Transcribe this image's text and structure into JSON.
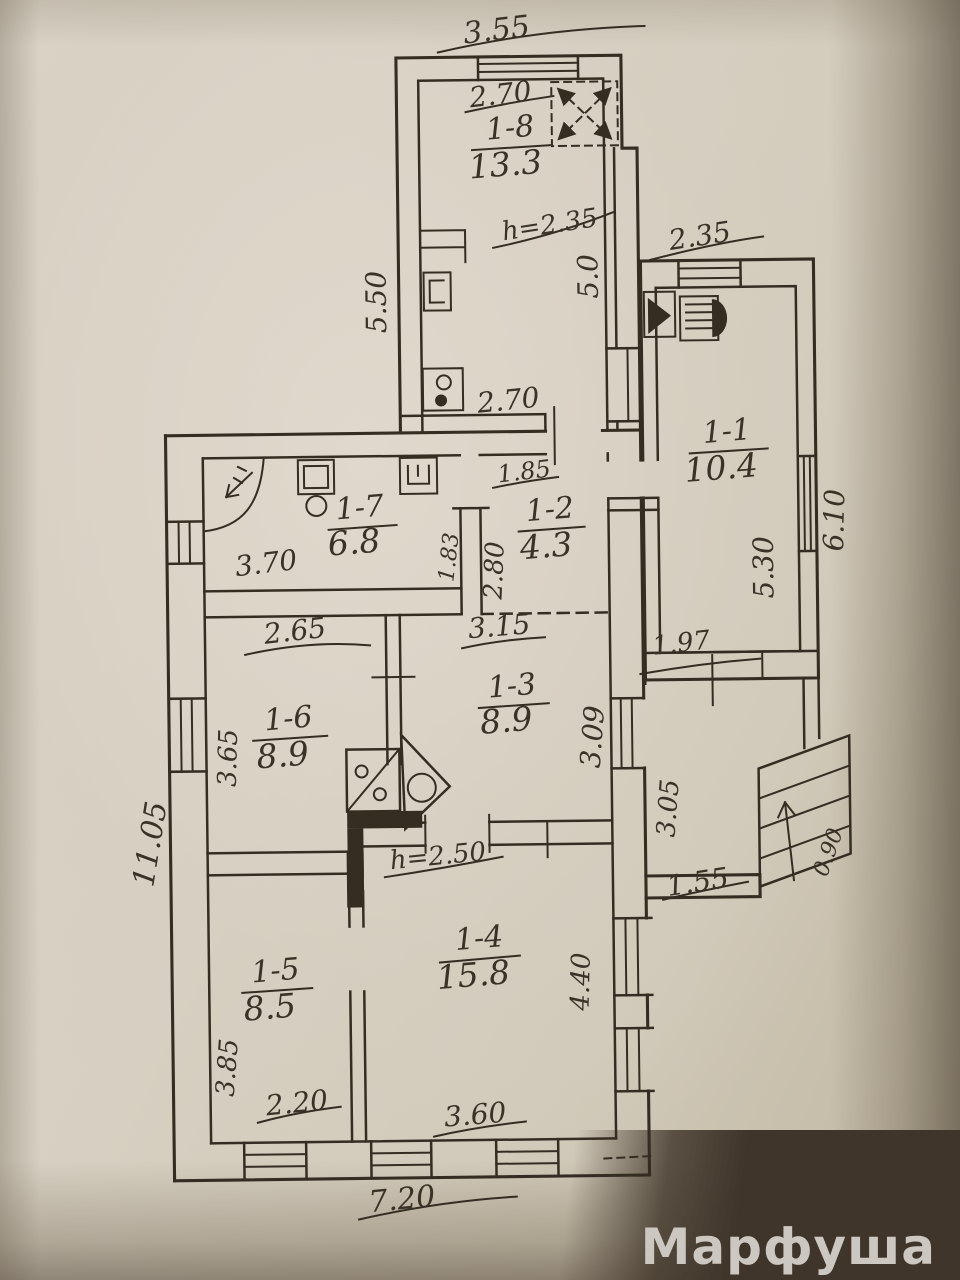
{
  "photo": {
    "watermark": "Марфуша"
  },
  "plan": {
    "rooms": {
      "r18": {
        "num": "1-8",
        "area": "13.3"
      },
      "r11": {
        "num": "1-1",
        "area": "10.4"
      },
      "r17": {
        "num": "1-7",
        "area": "6.8"
      },
      "r12": {
        "num": "1-2",
        "area": "4.3"
      },
      "r16": {
        "num": "1-6",
        "area": "8.9"
      },
      "r13": {
        "num": "1-3",
        "area": "8.9"
      },
      "r15": {
        "num": "1-5",
        "area": "8.5"
      },
      "r14": {
        "num": "1-4",
        "area": "15.8"
      }
    },
    "dims": {
      "top_width": "3.55",
      "r18_top": "2.70",
      "r18_height_note": "h=2.35",
      "r18_left": "5.50",
      "r18_right": "5.0",
      "r18_bottom": "2.70",
      "r11_top": "2.35",
      "r11_inner_right": "5.30",
      "r11_outer_right": "6.10",
      "r11_bottom": "1.97",
      "r17_bottom": "3.70",
      "r17_right": "1.83",
      "r12_top": "1.85",
      "r12_left": "2.80",
      "r12_bottom": "3.15",
      "r16_top": "2.65",
      "r16_left": "3.65",
      "r13_right": "3.09",
      "porch_left": "3.05",
      "porch_bottom": "1.55",
      "stairs_width": "0.90",
      "r14_height_note": "h=2.50",
      "r14_right": "4.40",
      "r14_bottom": "3.60",
      "r15_left": "3.85",
      "r15_bottom": "2.20",
      "left_total": "11.05",
      "bottom_total": "7.20"
    }
  }
}
